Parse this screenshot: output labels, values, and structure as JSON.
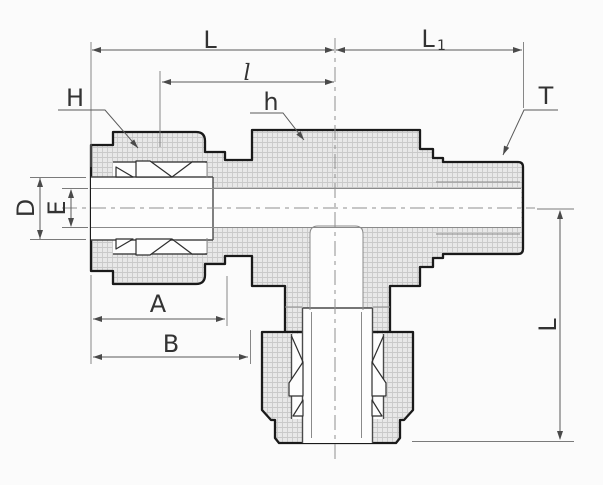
{
  "drawing": {
    "description": "Sectioned engineering drawing of a run tee compression tube fitting: tube nut with ferrules on the left end, hex body in the middle, male threaded end on the right, and a second tube nut on the downward branch",
    "view": "side cross-section with dimension callouts",
    "labels": {
      "overall_length": "L",
      "thread_end_length_main": "L",
      "thread_end_length_sub": "1",
      "center_to_tube_end": "l",
      "nut_hex_flats": "H",
      "body_hex_flats": "h",
      "male_thread": "T",
      "tube_outer_diameter": "D",
      "bore_diameter": "E",
      "nut_length": "A",
      "body_front_length": "B",
      "branch_length": "L"
    },
    "colors": {
      "background": "#fbfbfb",
      "outline": "#1a1a1a",
      "section_fill": "#e8e8e8",
      "section_hatch": "#c6c6c6",
      "dimension_lines": "#5a5a5a",
      "centerlines": "#8f8f8f",
      "label_text": "#333333"
    }
  }
}
